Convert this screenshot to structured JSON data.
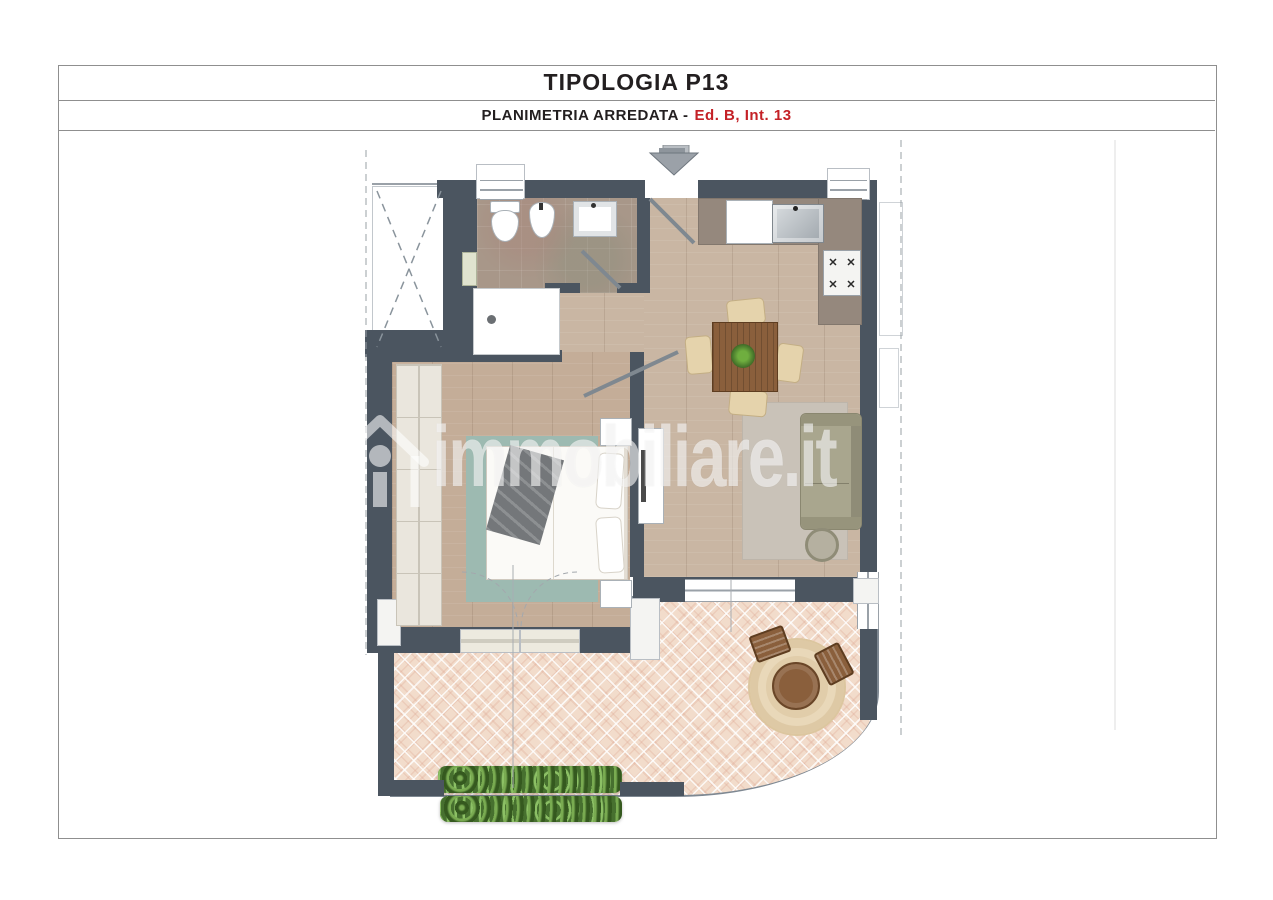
{
  "document": {
    "title": "TIPOLOGIA P13",
    "subtitle_label": "PLANIMETRIA ARREDATA -",
    "subtitle_unit": "Ed. B, Int. 13"
  },
  "watermark": {
    "brand": "immobiliare.it"
  },
  "plan": {
    "stove_burner_glyph": "✕"
  },
  "colors": {
    "accent_red": "#c42127",
    "title_text": "#231f20",
    "wall": "#4b5560",
    "wood": "#c9b6a3",
    "bedroom_wood": "#c4ad98",
    "bath_tile": "#a89789",
    "counter": "#95887d",
    "terrace_tile": "#f2dccb",
    "teal_rug": "#9dbab1",
    "gray_rug": "#c9c2b8",
    "sofa": "#a9a68e",
    "wood_dark": "#8a5f3c",
    "chair_cream": "#e5d3ac",
    "planter_green": "#47702f",
    "line_gray": "#8d959d"
  }
}
